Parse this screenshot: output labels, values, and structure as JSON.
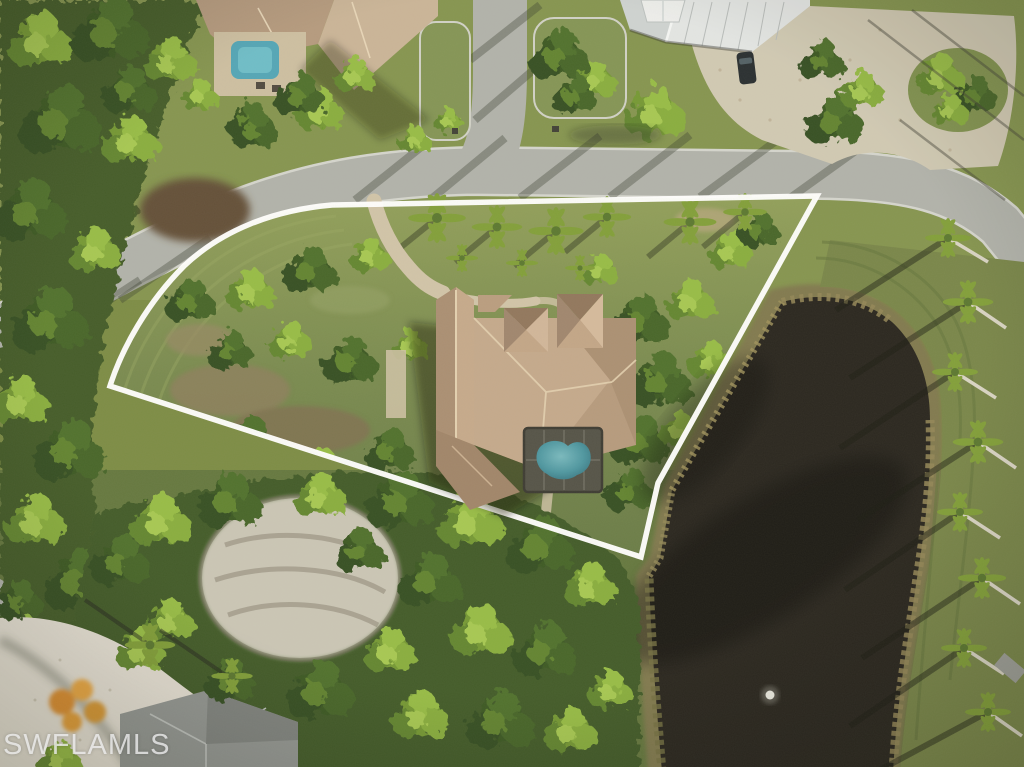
{
  "image": {
    "type": "aerial-drone-photo",
    "description": "Overhead aerial photo of a residential estate lot outlined with a white boundary line; tan hip-roof house with screened pool, curving street above, dark pond on the right with palm-lined bank, dense woods left and below, neighboring homes at the edges.",
    "watermark": "SWFLAMLS"
  },
  "scene": {
    "features": [
      "property-boundary-line",
      "subject-lot-lawn",
      "main-house-roof",
      "pool-screen-enclosure",
      "swimming-pool",
      "driveway",
      "palm-row",
      "pond",
      "pond-fountain",
      "main-road",
      "side-road",
      "forest-left",
      "forest-bottom",
      "sand-clearing",
      "neighbor-house-top-left",
      "neighbor-pool-top-left",
      "neighbor-house-top-right",
      "gazebo",
      "parked-suv",
      "gravel-driveway",
      "shell-driveway",
      "neighbor-house-bottom-left",
      "flowering-bush",
      "right-palm-alley"
    ]
  },
  "colors": {
    "boundary": "#ffffff",
    "water": "#211e17",
    "lawn": "#77883f",
    "lotLawn": "#7e8f4a",
    "roofTan": "#bfa286",
    "poolTeal": "#47939e",
    "road": "#aeb0a9",
    "metalRoof": "#e2e5e4",
    "gravel": "#cfc8b2",
    "shell": "#e3ded2",
    "watermarkText": "#ebebeb"
  }
}
